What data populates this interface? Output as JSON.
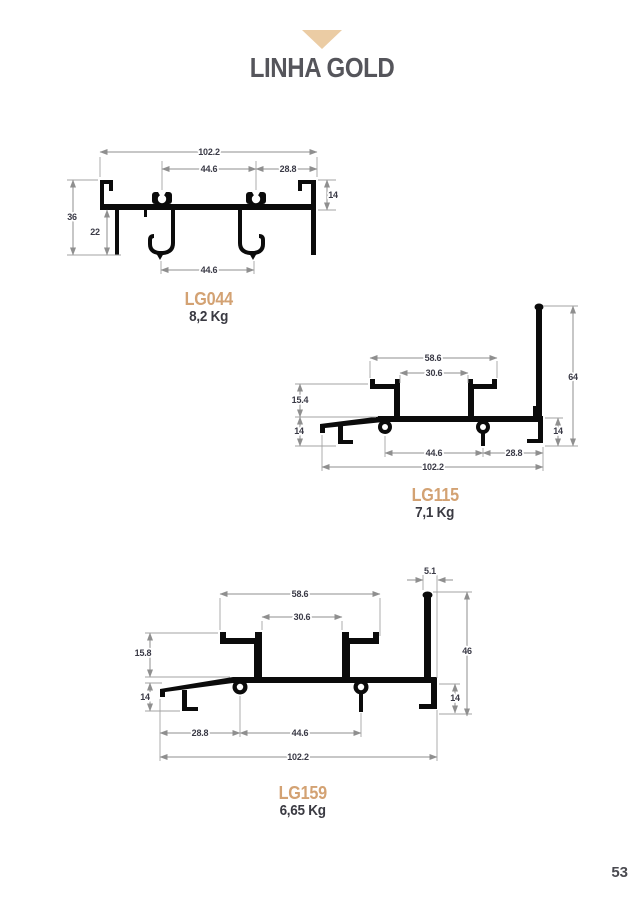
{
  "header": {
    "marker_icon": "triangle-down",
    "title": "LINHA GOLD"
  },
  "footer": {
    "page_number": "53"
  },
  "colors": {
    "accent_gold": "#D3A273",
    "triangle_tan": "#EBCCA4",
    "title_gray": "#55555B",
    "weight_gray": "#3A3A42",
    "dim_text": "#3A3A46",
    "dim_line": "#8F8F8F",
    "profile_black": "#0B0B0B"
  },
  "profiles": [
    {
      "code": "LG044",
      "weight": "8,2 Kg",
      "dims": {
        "total_width": "102.2",
        "track_spacing_top": "44.6",
        "right_offset": "28.8",
        "lip_height": "14",
        "overall_height": "36",
        "lower_height": "22",
        "track_spacing_bottom": "44.6"
      }
    },
    {
      "code": "LG115",
      "weight": "7,1 Kg",
      "dims": {
        "glazing_outer": "58.6",
        "glazing_inner": "30.6",
        "upper_left_height": "15.4",
        "lower_left_height": "14",
        "fin_height": "64",
        "lower_right_height": "14",
        "boss_spacing": "44.6",
        "right_offset": "28.8",
        "total_width": "102.2"
      }
    },
    {
      "code": "LG159",
      "weight": "6,65 Kg",
      "dims": {
        "fin_offset": "5.1",
        "glazing_outer": "58.6",
        "glazing_inner": "30.6",
        "upper_left_height": "15.8",
        "lower_left_height": "14",
        "fin_height": "46",
        "lower_right_height": "14",
        "left_offset": "28.8",
        "boss_spacing": "44.6",
        "total_width": "102.2"
      }
    }
  ]
}
